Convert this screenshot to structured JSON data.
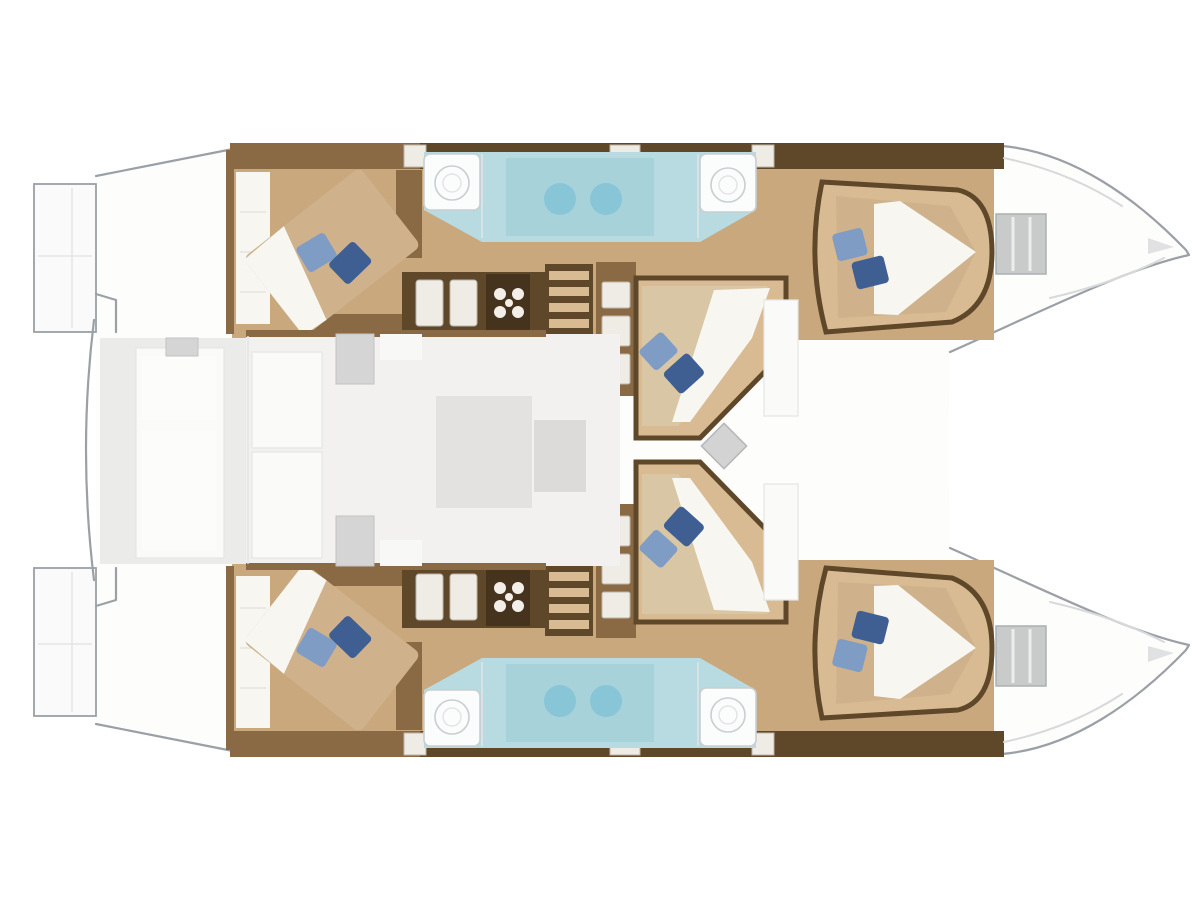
{
  "diagram": {
    "kind": "catamaran-floor-plan-top-view",
    "orientation": {
      "bow": "right",
      "stern": "left"
    },
    "visible_features": {
      "double_beds": 6,
      "blue_pillows_per_bed": 2,
      "vanity_basins": 4,
      "shower_counter_zones": 2,
      "companionway_stairs": 2,
      "stove_icons": 2,
      "bow_deck_hatches": 2,
      "mast": 1,
      "cockpit_bench": 1,
      "salon_table": 1,
      "swim_platforms": 2
    }
  },
  "colors": {
    "background": "#ffffff",
    "deck": "#fdfdfc",
    "deck_line": "#9aa0a5",
    "transom": "#fafafa",
    "faintline": "#e4e4e4",
    "cockpit_floor": "#ebebea",
    "salon_floor": "#f2f1f0",
    "furniture_faint": "#fafaf9",
    "table_gray": "#e3e2e1",
    "console_gray": "#d4d5d4",
    "wood_floor": "#c9a87e",
    "wood_light": "#d8bb92",
    "joinery_dark": "#5f472a",
    "joinery_mid": "#8a6a44",
    "joinery_deep": "#46331d",
    "bed_tan": "#cfb28c",
    "bed_light": "#d9c6a4",
    "sheet_white": "#f7f6f1",
    "pillow_light": "#7f9cc4",
    "pillow_dark": "#3f5f93",
    "bath_counter": "#b7dbe0",
    "bath_deep": "#a8d2da",
    "bath_glow": "#7fc3d6",
    "fixture_white": "#fbfcfc",
    "fixture_line": "#c9ced0",
    "hatch_gray": "#c9cbca",
    "hatch_line": "#aab0b2",
    "mast_gray": "#d2d3d2",
    "stripe_tan": "#d8bb92",
    "step_white": "#efece6"
  }
}
